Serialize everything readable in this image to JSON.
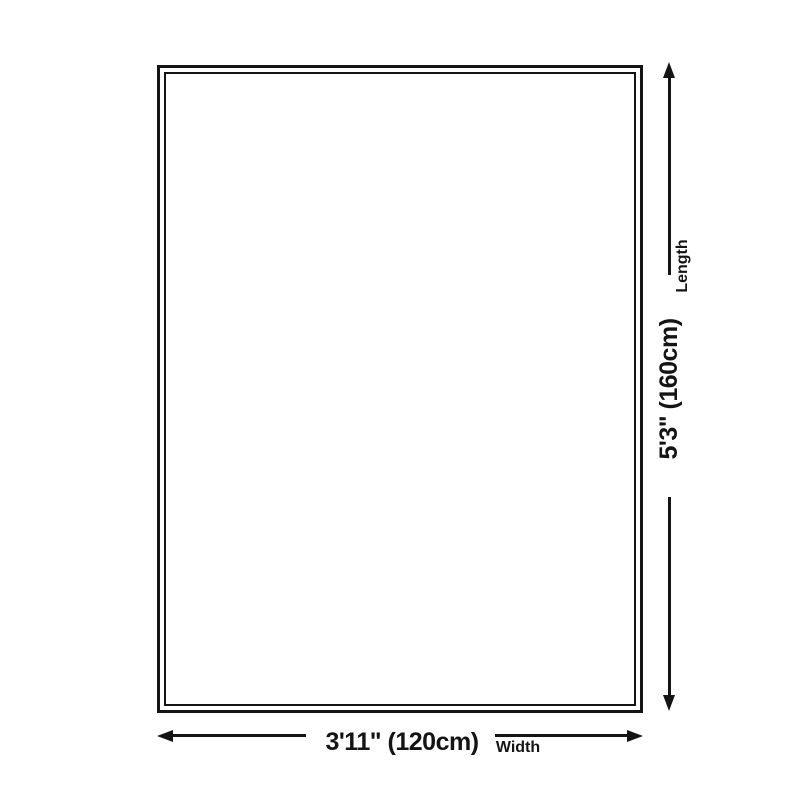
{
  "diagram": {
    "shape": "rectangle-double-border",
    "line_color": "#141414",
    "background_color": "#ffffff",
    "length_dimension": {
      "value": "5'3\" (160cm)",
      "axis_label": "Length"
    },
    "width_dimension": {
      "value": "3'11\" (120cm)",
      "axis_label": "Width"
    }
  }
}
